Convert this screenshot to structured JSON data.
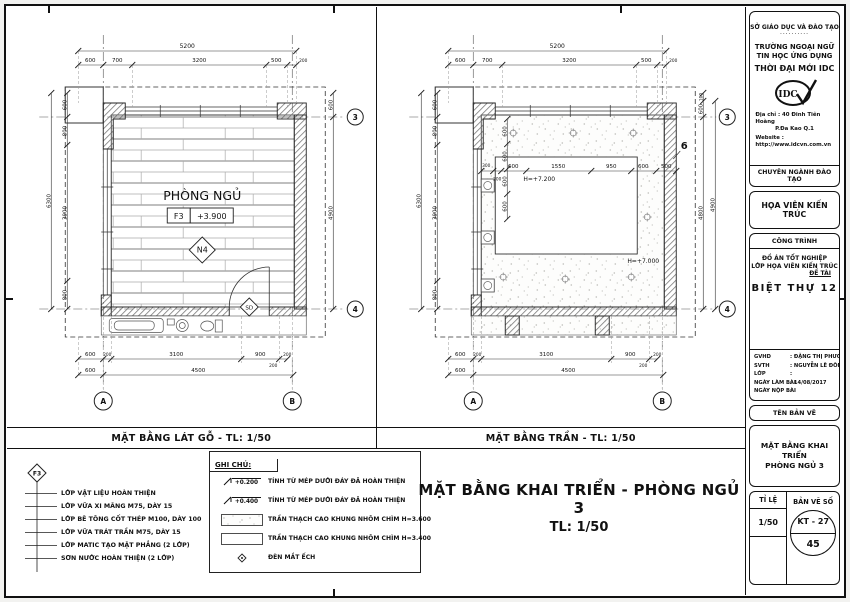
{
  "plans": {
    "left": {
      "caption": "MẶT BẰNG LÁT GỖ  - TL: 1/50",
      "room": "PHÒNG NGỦ",
      "finish_tag": "F3",
      "level": "+3.900",
      "note_tag": "N4",
      "door_tag": "SD"
    },
    "right": {
      "caption": "MẶT BẰNG TRẦN - TL: 1/50",
      "h_center": "H=+7.200",
      "h_field": "H=+7.000",
      "section_tag": "6"
    }
  },
  "grid": {
    "col_a": "A",
    "col_b": "B",
    "row_3": "3",
    "row_4": "4"
  },
  "dims": {
    "top_total": "5200",
    "top": [
      "600",
      "700",
      "3200",
      "500",
      "200"
    ],
    "left_total": "6300",
    "left": [
      "600",
      "800",
      "3900",
      "800"
    ],
    "right": [
      "600",
      "4900"
    ],
    "right_outer": "4900",
    "right_inner": [
      "600",
      "4800"
    ],
    "right_small": "100",
    "bottom": [
      "600",
      "200",
      "3100",
      "900",
      "200"
    ],
    "bottom_extra": "200",
    "bottom2": [
      "600",
      "4500"
    ],
    "interior_h": [
      "300",
      "200",
      "600",
      "1550",
      "950",
      "600",
      "500"
    ],
    "interior_v": [
      "600",
      "600",
      "600",
      "600"
    ]
  },
  "legend_layers": {
    "marker": "F3",
    "items": [
      "LỚP VẬT LIỆU HOÀN THIỆN",
      "LỚP VỮA XI MĂNG M75, DÀY 15",
      "LỚP BÊ TÔNG CỐT THÉP M100, DÀY 100",
      "LỚP VỮA TRÁT TRẦN M75, DÀY 15",
      "LỚP MATIC TẠO MẶT PHẲNG (2 LỚP)",
      "SƠN NƯỚC HOÀN THIỆN (2 LỚP)"
    ]
  },
  "notes": {
    "header": "GHI CHÚ:",
    "level_items": [
      {
        "value": "+0.200",
        "text": "TÍNH TỪ MÉP DƯỚI ĐÁY ĐÃ HOÀN THIỆN"
      },
      {
        "value": "+0.400",
        "text": "TÍNH TỪ MÉP DƯỚI ĐÁY ĐÃ HOÀN THIỆN"
      }
    ],
    "swatch_items": [
      {
        "text": "TRẦN THẠCH CAO KHUNG NHÔM CHÌM H=3.600"
      },
      {
        "text": "TRẦN THẠCH CAO KHUNG NHÔM CHÌM H=3.400"
      }
    ],
    "symbol_items": [
      {
        "text": "ĐÈN MẮT ẾCH"
      }
    ]
  },
  "main_title": {
    "line1": "MẶT BẰNG KHAI TRIỂN - PHÒNG NGỦ 3",
    "line2": "TL:  1/50"
  },
  "title_block": {
    "dept": "SỞ GIÁO DỤC VÀ ĐÀO TẠO",
    "dots": "..........",
    "school_line1": "TRƯỜNG NGOẠI NGỮ",
    "school_line2": "TIN HỌC ỨNG DỤNG",
    "school_name": "THỜI ĐẠI MỚI IDC",
    "logo_text": "IDC",
    "address_label": "Địa chỉ :",
    "address_value": "40 Đinh Tiên Hoàng",
    "address_value2": "P.Đa Kao    Q.1",
    "website_label": "Website :",
    "website_value": "http://www.idcvn.com.vn",
    "program_header": "CHUYÊN NGÀNH ĐÀO TẠO",
    "program_name": "HỌA VIÊN KIẾN TRÚC",
    "project_header": "CÔNG TRÌNH",
    "project_line1": "ĐỒ ÁN TỐT NGHIỆP",
    "project_line2": "LỚP HỌA VIÊN KIẾN TRÚC",
    "topic_label": "ĐỀ TÀI",
    "project_name": "BIỆT THỰ 12",
    "fields": [
      {
        "label": "GVHD",
        "value": ": ĐẶNG THỊ PHƯƠNG CHI"
      },
      {
        "label": "SVTH",
        "value": ": NGUYỄN LÊ ĐÔNG NHI"
      },
      {
        "label": "LỚP",
        "value": ":"
      },
      {
        "label": "NGÀY LÀM BÀI",
        "value": ":   14/08/2017"
      },
      {
        "label": "NGÀY NỘP BÀI",
        "value": ":"
      }
    ],
    "drawing_name_header": "TÊN BẢN VẼ",
    "drawing_name_line1": "MẶT BẰNG KHAI TRIỂN",
    "drawing_name_line2": "PHÒNG NGỦ 3",
    "scale_label": "TỈ LỆ",
    "scale_value": "1/50",
    "sheet_no_label": "BẢN VẼ SỐ",
    "sheet_code": "KT - 27",
    "sheet_number": "45"
  }
}
